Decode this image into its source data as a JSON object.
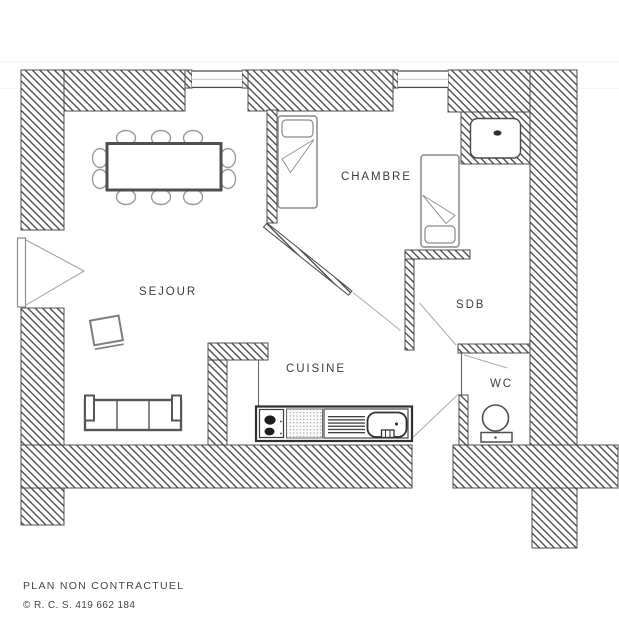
{
  "page": {
    "background": "#ffffff",
    "width_px": 619,
    "height_px": 640
  },
  "plan": {
    "rooms": [
      {
        "id": "sejour",
        "label": "SEJOUR"
      },
      {
        "id": "chambre",
        "label": "CHAMBRE"
      },
      {
        "id": "cuisine",
        "label": "CUISINE"
      },
      {
        "id": "sdb",
        "label": "SDB"
      },
      {
        "id": "wc",
        "label": "WC"
      }
    ],
    "fixtures": [
      "dining-table-with-10-chairs",
      "sofa",
      "side-chair",
      "single-bed-chambre-left",
      "single-bed-chambre-right",
      "shower-tray",
      "toilet",
      "kitchen-counter-stove-drainer-sink",
      "entry-double-door",
      "window-sejour",
      "window-chambre"
    ],
    "colors": {
      "wall_hatch_line": "#4b4b4b",
      "outline_ink": "#3f3f3f",
      "furniture_line": "#8a8a8a",
      "label_ink": "#3e3e3e",
      "background": "#ffffff"
    }
  },
  "footer": {
    "disclaimer": "PLAN NON CONTRACTUEL",
    "registration": "© R. C. S. 419 662 184"
  }
}
